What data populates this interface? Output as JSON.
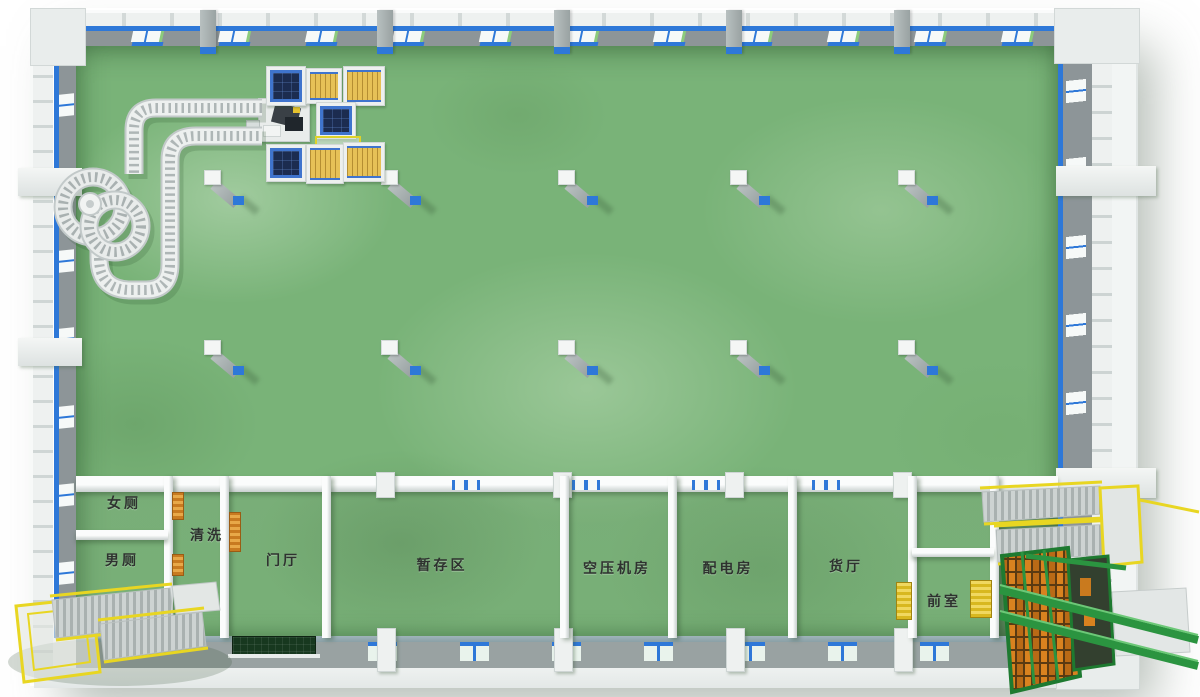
{
  "labels": {
    "women_toilet": "女厕",
    "men_toilet": "男厕",
    "washing": "清洗",
    "entrance_hall": "门厅",
    "staging_area": "暂存区",
    "air_compressor_room": "空压机房",
    "power_distribution_room": "配电房",
    "cargo_hall": "货厅",
    "front_room": "前室"
  },
  "palette": {
    "floor_green": "#79b378",
    "floor_light": "#a9d0a0",
    "floor_dark": "#5a985c",
    "wall_light": "#eef1f0",
    "wall_face_gray": "#8d9598",
    "accent_blue": "#2e78d8",
    "pallet_yellow": "#e6c157",
    "pallet_dark_navy": "#1c2c50",
    "pallet_frame_blue": "#3f74cd",
    "railing_yellow": "#e8d622",
    "machine_green": "#2b9440",
    "door_orange": "#d08030"
  },
  "equipment_icons": {
    "spiral": "spiral-conveyor",
    "loop": "roller-conveyor",
    "robot": "palletizer-robot",
    "stairs": "yellow-rail-staircase",
    "lift": "green-rack-lift"
  }
}
